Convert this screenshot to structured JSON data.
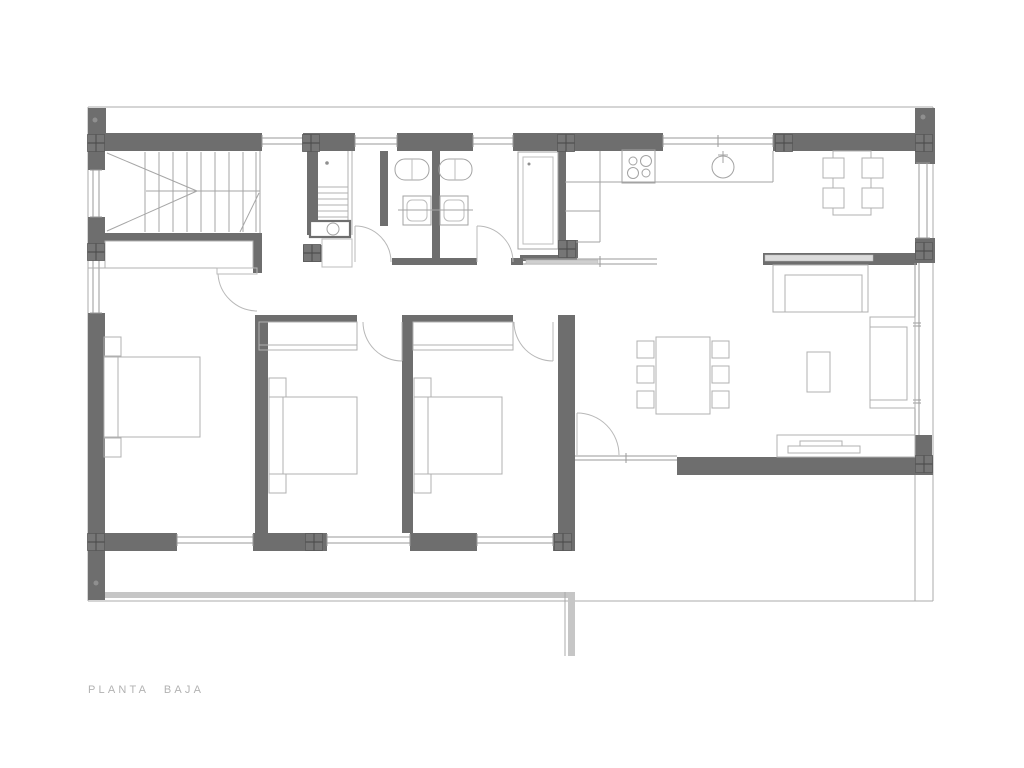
{
  "title": {
    "label": "PLANTA BAJA"
  },
  "palette": {
    "wall": "#6e6e6e",
    "glass": "#9a9a9a",
    "furniture": "#b0b0b0",
    "slab": "#c6c6c6",
    "label": "#b2b2b2",
    "background": "#ffffff"
  },
  "fixtures": [
    "staircase",
    "utility-stair",
    "washing-machine",
    "vanity-sink",
    "toilet",
    "shower",
    "stove",
    "kitchen-sink",
    "breakfast-table",
    "dining-table",
    "sofa",
    "coffee-table",
    "tv-unit",
    "bed",
    "nightstand",
    "wardrobe",
    "door-swing",
    "window",
    "column-marker"
  ]
}
